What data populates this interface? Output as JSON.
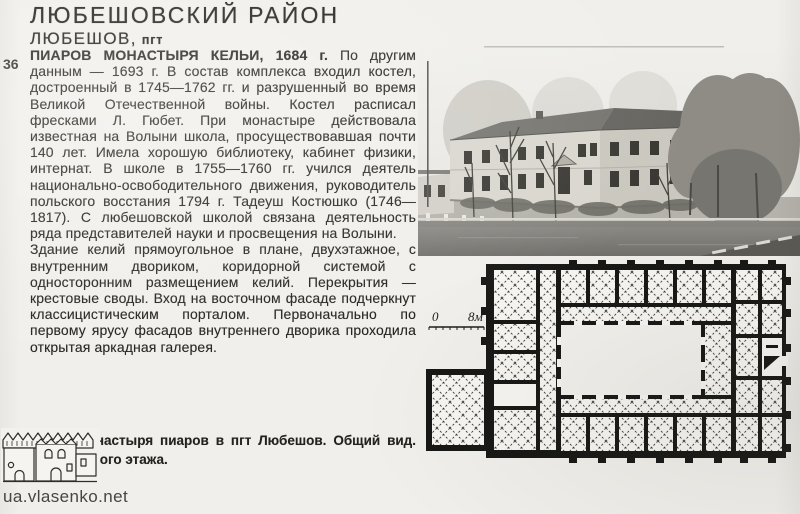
{
  "header": {
    "title": "ЛЮБЕШОВСКИЙ РАЙОН",
    "town": "ЛЮБЕШОВ,",
    "town_status": "пгт"
  },
  "margin": {
    "page_number": "36"
  },
  "article": {
    "lead_bold": "ПИАРОВ МОНАСТЫРЯ КЕЛЬИ, 1684 г.",
    "para1": "По другим данным — 1693 г. В состав комплекса входил костел, достроенный в 1745—1762 гг. и разрушенный во время Великой Отечественной войны. Костел расписал фресками Л. Гюбет. При монастыре действовала известная на Волыни школа, просуществовавшая почти 140 лет. Имела хорошую библиотеку, кабинет физики, интернат. В школе в 1755—1760 гг. учился деятель национально-освободительного движения, руководитель польского восстания 1794 г. Тадеуш Костюшко (1746—1817). С любешовской школой связана деятельность ряда представителей науки и просвещения на Волыни.",
    "para2": "Здание келий прямоугольное в плане, двухэтажное, с внутренним двориком, коридорной системой с односторонним размещением келий. Перекрытия — крестовые своды. Вход на восточном фасаде подчеркнут классицистическим порталом. Первоначально по первому ярусу фасадов внутреннего дворика проходила открытая аркадная галерея."
  },
  "caption": {
    "line1": "Кельи монастыря пиаров в пгт Любешов. Общий вид.",
    "line2": "План первого этажа."
  },
  "plan_scale": {
    "zero": "0",
    "eight_m": "8м"
  },
  "watermark": "ua.vlasenko.net",
  "colors": {
    "paper": "#f1efeb",
    "ink": "#23221f",
    "plan_walls": "#161614"
  }
}
